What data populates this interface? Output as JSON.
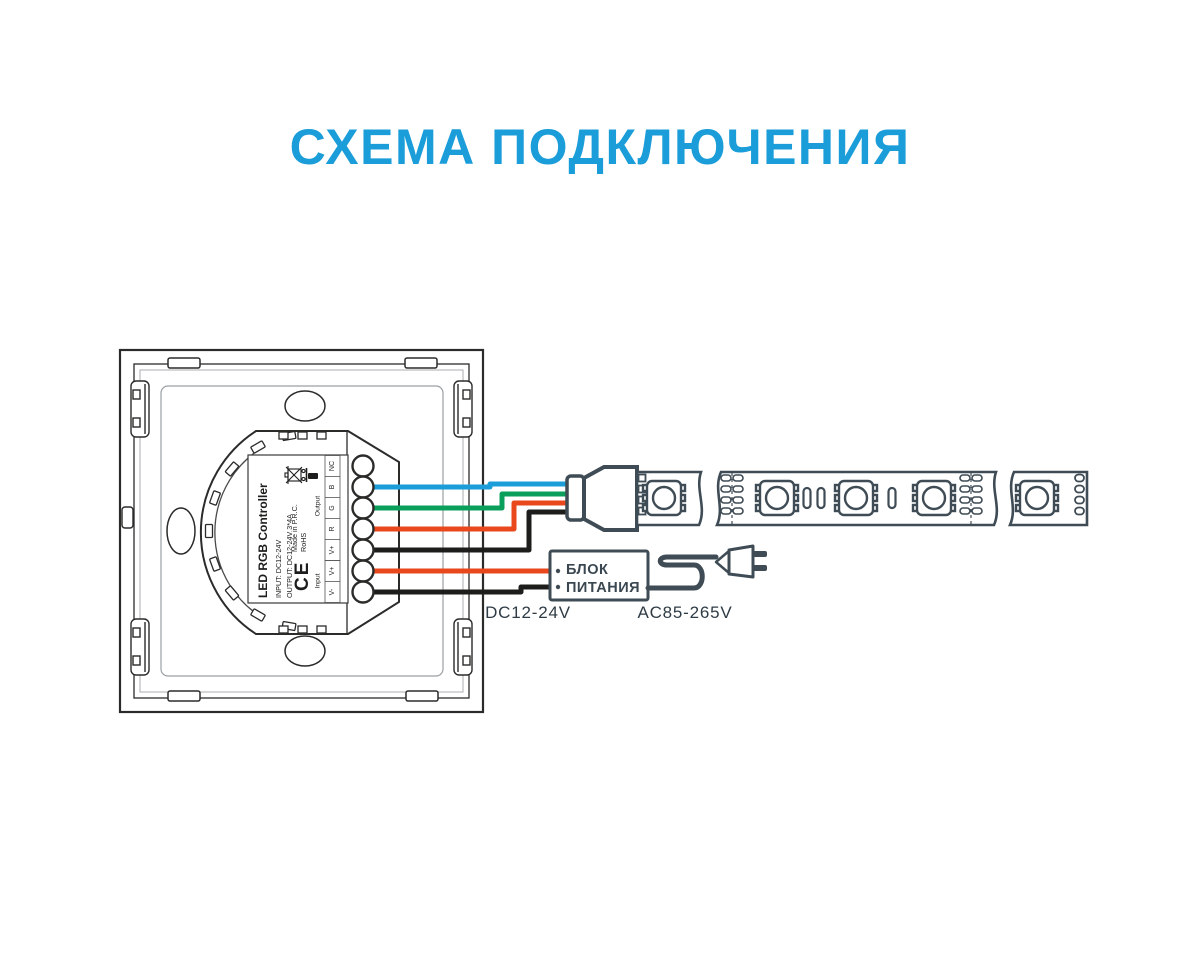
{
  "title": "СХЕМА ПОДКЛЮЧЕНИЯ",
  "colors": {
    "title_blue": "#1a9dd9",
    "wire_blue": "#1a9dd9",
    "wire_green": "#0aa05c",
    "wire_red": "#e8481c",
    "wire_black": "#1d1d1b",
    "device_outline": "#3f4c55",
    "panel_line": "#2b2b29"
  },
  "controller": {
    "label": {
      "product": "LED RGB Controller",
      "input": "INPUT: DC12-24V",
      "output": "OUTPUT: DC12-24V 3*4A",
      "ce_mark": "CE",
      "made_in": "Made in P.R.C.",
      "rohs": "RoHS"
    },
    "terminals": {
      "output_group": "Output",
      "input_group": "Input",
      "output_pins": [
        "NC",
        "B",
        "G",
        "R",
        "V+"
      ],
      "input_pins": [
        "V+",
        "V-"
      ]
    }
  },
  "power_supply": {
    "name_line1": "БЛОК",
    "name_line2": "ПИТАНИЯ",
    "dc_rating": "DC12-24V",
    "ac_rating": "AC85-265V"
  },
  "wires": [
    {
      "id": "blue-b",
      "color": "#1a9dd9"
    },
    {
      "id": "green-g",
      "color": "#0aa05c"
    },
    {
      "id": "red-r",
      "color": "#e8481c"
    },
    {
      "id": "black-vplus",
      "color": "#1d1d1b"
    },
    {
      "id": "red-input",
      "color": "#e8481c"
    },
    {
      "id": "black-input",
      "color": "#1d1d1b"
    }
  ]
}
